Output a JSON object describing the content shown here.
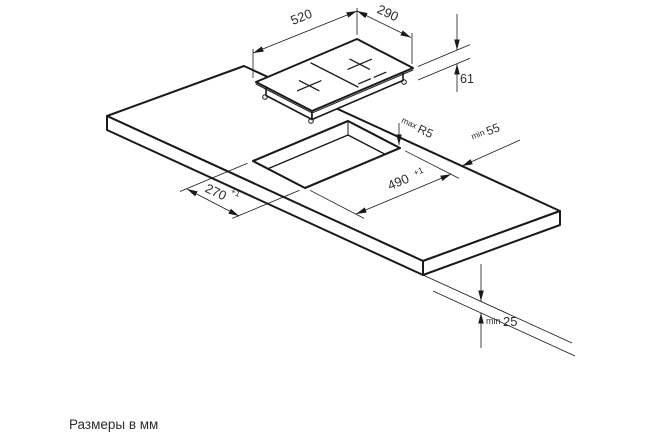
{
  "diagram": {
    "kind": "hob-installation-drawing",
    "subject": "built-in domino hob and worktop cutout",
    "units_note": "Размеры в мм"
  },
  "dims": {
    "hob_length": "520",
    "hob_width": "290",
    "hob_height": "61",
    "corner_radius_prefix": "max",
    "corner_radius_value": "R5",
    "back_clearance_prefix": "min",
    "back_clearance_value": "55",
    "cutout_length_value": "490",
    "cutout_length_tolerance": "+1",
    "cutout_width_value": "270",
    "cutout_width_tolerance": "+1",
    "bottom_clearance_prefix": "min",
    "bottom_clearance_value": "25"
  },
  "colors": {
    "line": "#1a1a1a",
    "text": "#2d2d2d",
    "background": "#ffffff"
  }
}
